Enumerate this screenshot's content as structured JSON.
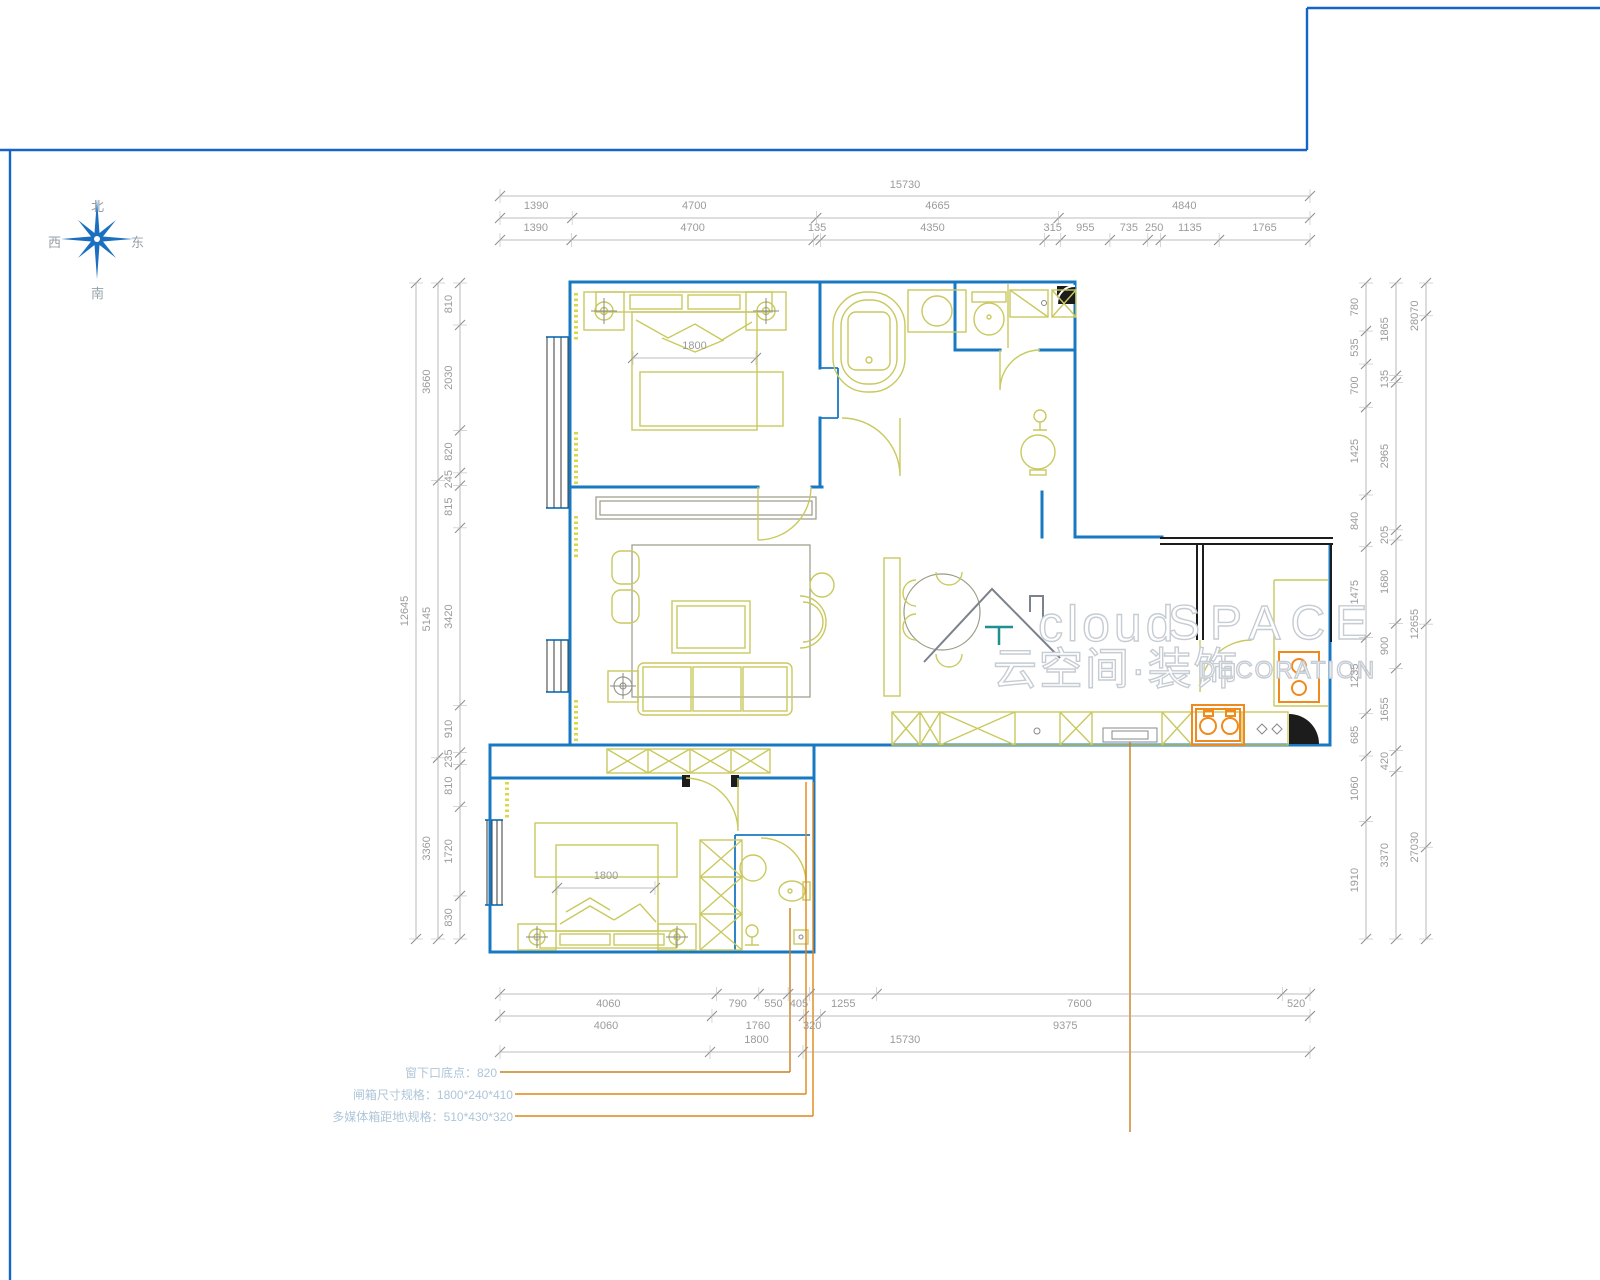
{
  "compass": {
    "north": "北",
    "south": "南",
    "west": "西",
    "east": "东"
  },
  "watermark": {
    "logo": "house-roof-icon",
    "en_prefix": "cloud",
    "en_main": "SPACE",
    "zh": "云空间·装饰",
    "en_sub": "DECORATION"
  },
  "plan": {
    "bedroom1_bed_width": "1800",
    "bedroom2_bed_width": "1800"
  },
  "dimensions": {
    "top": {
      "total": "15730",
      "row1": [
        "1390",
        "4700",
        "4665",
        "4840"
      ],
      "row2": [
        "1390",
        "4700",
        "135",
        "4350",
        "315",
        "955",
        "735",
        "250",
        "1135",
        "1765"
      ]
    },
    "bottom": {
      "row1": [
        "4060",
        "790",
        "550",
        "405",
        "1255",
        "7600",
        "520"
      ],
      "row2": [
        "4060",
        "1760",
        "320",
        "9375"
      ],
      "row3_segment": "1800",
      "total": "15730"
    },
    "left": {
      "total": "12645",
      "row1": [
        "3660",
        "5145",
        "3360"
      ],
      "row2": [
        "810",
        "2030",
        "820",
        "245",
        "815",
        "3420",
        "910",
        "235",
        "810",
        "1720",
        "830"
      ]
    },
    "right": {
      "inner": [
        "780",
        "535",
        "700",
        "1425",
        "840",
        "1475",
        "1235",
        "685",
        "1060",
        "1910"
      ],
      "middle": [
        "1865",
        "135",
        "2965",
        "205",
        "1680",
        "900",
        "1655",
        "420",
        "3370"
      ],
      "outer": [
        "28070",
        "12655",
        "27030"
      ]
    }
  },
  "notes": [
    {
      "label": "窗下口底点：820"
    },
    {
      "label": "闸箱尺寸规格：1800*240*410"
    },
    {
      "label": "多媒体箱距地\\规格：510*430*320"
    }
  ],
  "colors": {
    "wall": "#1879c2",
    "furniture": "#c9c95f",
    "dimension": "#9b9b9b",
    "orange": "#f08a1d",
    "leader": "#c9801f",
    "frame": "#1565c8",
    "compass": "#1b6fc0",
    "note_text": "#aec6d8"
  }
}
